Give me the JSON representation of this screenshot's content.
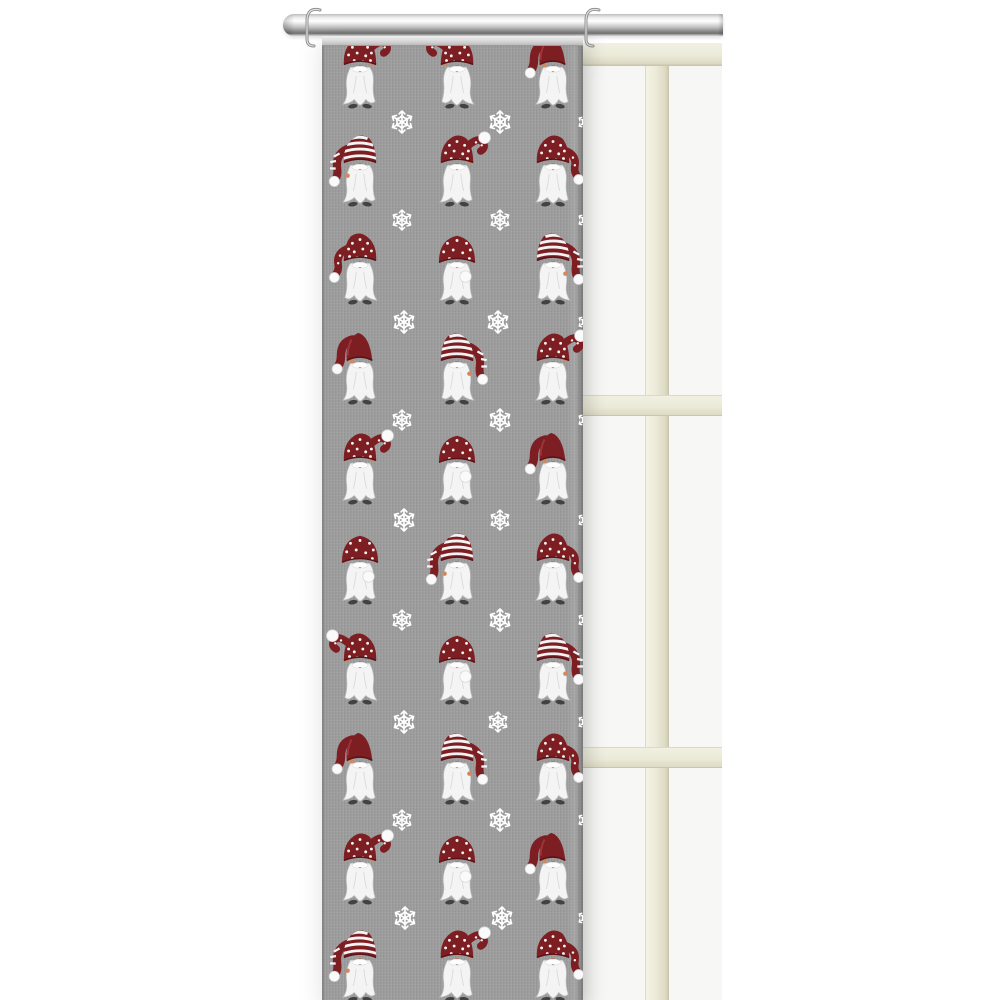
{
  "scene": {
    "subject": "gray panel curtain with christmas gnome and snowflake pattern",
    "setting": "hanging from a chrome rod in front of a cream window frame on white wall"
  },
  "colors": {
    "fabric": "#9b9b9b",
    "hat": "#7d1e23",
    "hat_dark": "#5c1216",
    "hat_light": "#a23a40",
    "beard": "#f4f4f4",
    "skin": "#d1895c",
    "boot": "#424242",
    "snow": "#ffffff",
    "frame": "#ecead9",
    "pane": "#f7f7f5",
    "rod": "#c9c9c9"
  },
  "curtain": {
    "pattern": {
      "columns_x": [
        38,
        135,
        231
      ],
      "gnome_rows": [
        {
          "y": 36,
          "variants": [
            {
              "v": "dotted_arc",
              "flip": false
            },
            {
              "v": "dotted_arc",
              "flip": true
            },
            {
              "v": "solid",
              "flip": false
            }
          ]
        },
        {
          "y": 134,
          "variants": [
            {
              "v": "striped",
              "flip": false
            },
            {
              "v": "dotted_arc",
              "flip": false
            },
            {
              "v": "dotted_droop",
              "flip": false
            }
          ]
        },
        {
          "y": 232,
          "variants": [
            {
              "v": "dotted_droop",
              "flip": true
            },
            {
              "v": "dome",
              "flip": false
            },
            {
              "v": "striped",
              "flip": true
            }
          ]
        },
        {
          "y": 332,
          "variants": [
            {
              "v": "solid",
              "flip": false
            },
            {
              "v": "striped",
              "flip": true
            },
            {
              "v": "dotted_arc",
              "flip": false
            }
          ]
        },
        {
          "y": 432,
          "variants": [
            {
              "v": "dotted_arc",
              "flip": false
            },
            {
              "v": "dome",
              "flip": false
            },
            {
              "v": "solid",
              "flip": false
            }
          ]
        },
        {
          "y": 532,
          "variants": [
            {
              "v": "dome",
              "flip": false
            },
            {
              "v": "striped",
              "flip": false
            },
            {
              "v": "dotted_droop",
              "flip": false
            }
          ]
        },
        {
          "y": 632,
          "variants": [
            {
              "v": "dotted_arc",
              "flip": true
            },
            {
              "v": "dome",
              "flip": false
            },
            {
              "v": "striped",
              "flip": true
            }
          ]
        },
        {
          "y": 732,
          "variants": [
            {
              "v": "solid",
              "flip": false
            },
            {
              "v": "striped",
              "flip": true
            },
            {
              "v": "dotted_droop",
              "flip": false
            }
          ]
        },
        {
          "y": 832,
          "variants": [
            {
              "v": "dotted_arc",
              "flip": false
            },
            {
              "v": "dome",
              "flip": false
            },
            {
              "v": "solid",
              "flip": false
            }
          ]
        },
        {
          "y": 929,
          "variants": [
            {
              "v": "striped",
              "flip": false
            },
            {
              "v": "dotted_arc",
              "flip": false
            },
            {
              "v": "dotted_droop",
              "flip": false
            }
          ]
        }
      ],
      "snowflake_rows": [
        {
          "y": 86,
          "flakes": [
            {
              "x": 80,
              "s": 1.1
            },
            {
              "x": 178,
              "s": 1.1
            },
            {
              "x": 264,
              "s": 0.8
            }
          ]
        },
        {
          "y": 184,
          "flakes": [
            {
              "x": 80,
              "s": 1.0
            },
            {
              "x": 178,
              "s": 1.0
            },
            {
              "x": 264,
              "s": 0.8
            }
          ]
        },
        {
          "y": 286,
          "flakes": [
            {
              "x": 82,
              "s": 1.1
            },
            {
              "x": 176,
              "s": 1.1
            },
            {
              "x": 264,
              "s": 0.8
            }
          ]
        },
        {
          "y": 384,
          "flakes": [
            {
              "x": 80,
              "s": 1.0
            },
            {
              "x": 178,
              "s": 1.1
            },
            {
              "x": 264,
              "s": 0.8
            }
          ]
        },
        {
          "y": 484,
          "flakes": [
            {
              "x": 82,
              "s": 1.1
            },
            {
              "x": 178,
              "s": 1.0
            },
            {
              "x": 264,
              "s": 0.8
            }
          ]
        },
        {
          "y": 584,
          "flakes": [
            {
              "x": 80,
              "s": 1.0
            },
            {
              "x": 178,
              "s": 1.1
            },
            {
              "x": 264,
              "s": 0.8
            }
          ]
        },
        {
          "y": 686,
          "flakes": [
            {
              "x": 82,
              "s": 1.1
            },
            {
              "x": 176,
              "s": 1.0
            },
            {
              "x": 264,
              "s": 0.8
            }
          ]
        },
        {
          "y": 784,
          "flakes": [
            {
              "x": 80,
              "s": 1.0
            },
            {
              "x": 178,
              "s": 1.1
            },
            {
              "x": 264,
              "s": 0.8
            }
          ]
        },
        {
          "y": 882,
          "flakes": [
            {
              "x": 83,
              "s": 1.1
            },
            {
              "x": 180,
              "s": 1.1
            },
            {
              "x": 264,
              "s": 0.8
            }
          ]
        }
      ]
    }
  },
  "rod": {
    "hooks": 2
  }
}
